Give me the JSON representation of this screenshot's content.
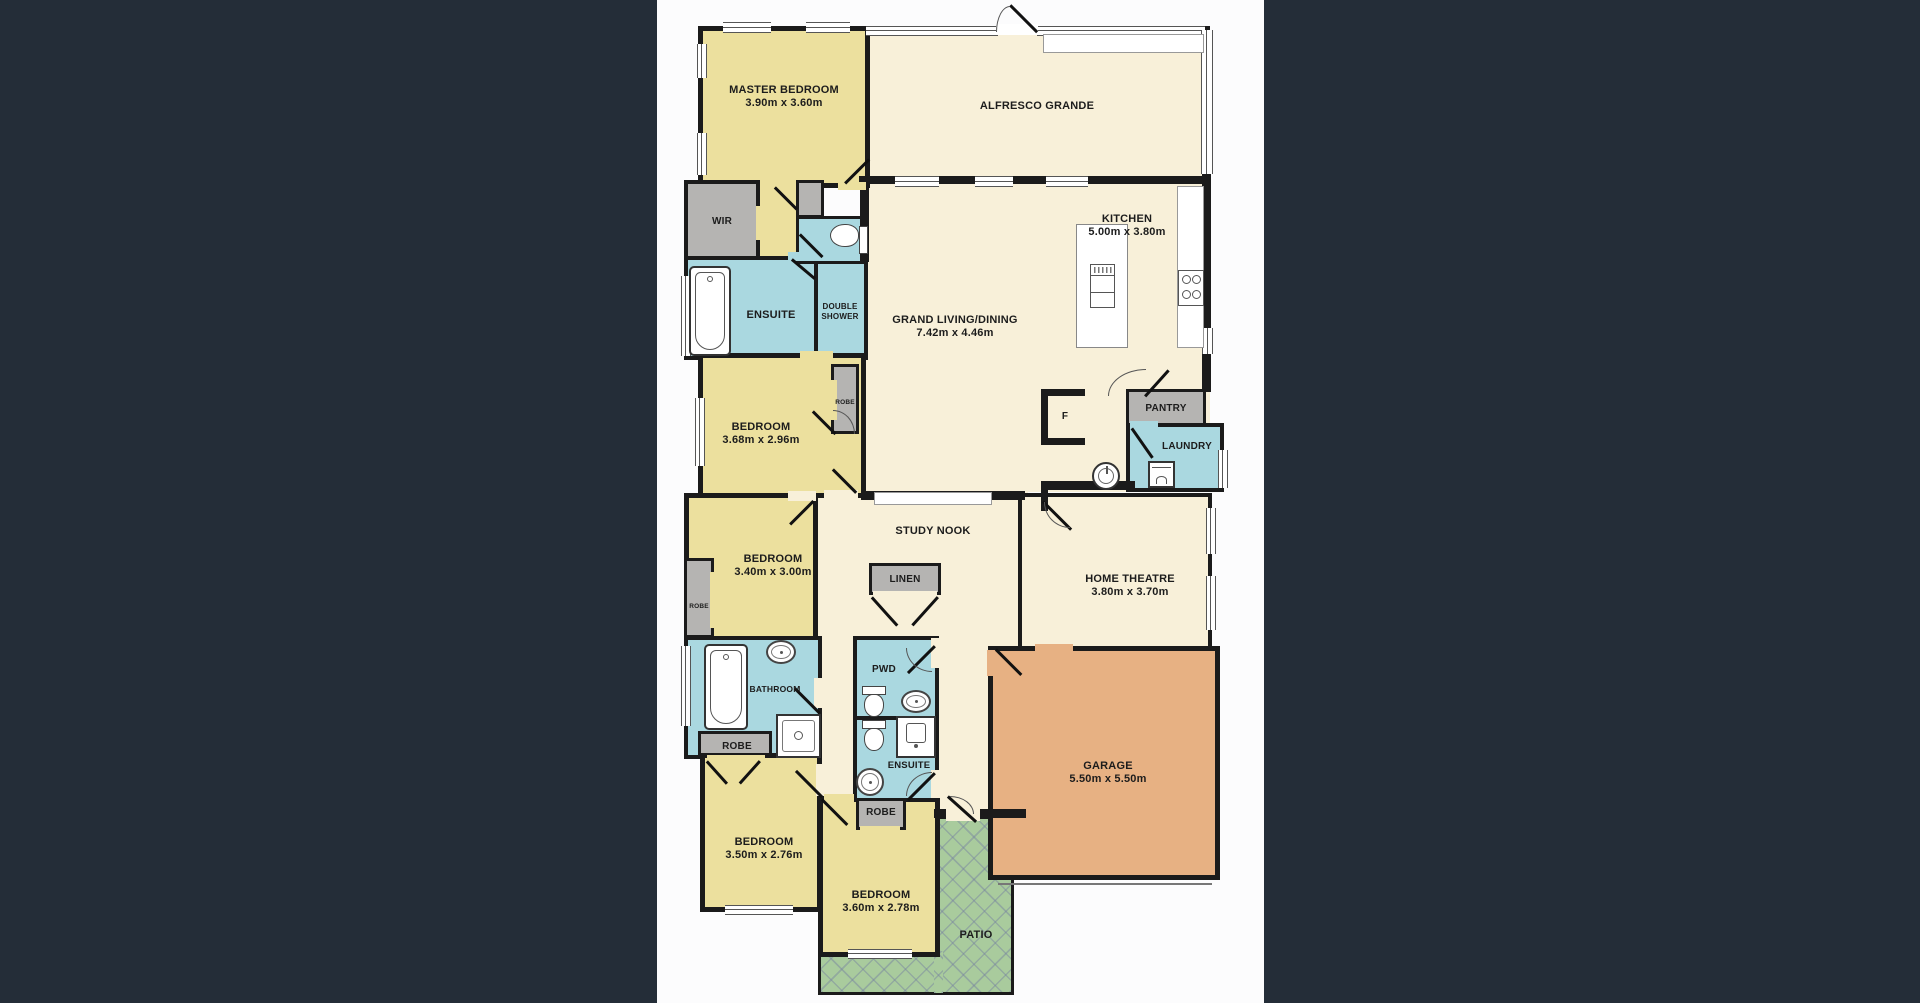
{
  "image": {
    "kind": "real-estate floor plan",
    "background_color": "#242d38",
    "canvas_color": "#fcfcfd",
    "canvas_x": 657,
    "canvas_width": 607
  },
  "plan": {
    "colors": {
      "cream": "#f8f0d9",
      "yellow": "#ece09e",
      "blue": "#aad8e0",
      "gray": "#b5b4b2",
      "orange": "#e7b183",
      "green": "#a9cb9d",
      "white": "#ffffff",
      "wall": "#1b1b1b",
      "text": "#1c1c1c"
    },
    "bases": [
      {
        "id": "living-kitchen",
        "x": 861,
        "y": 178,
        "w": 349,
        "h": 247,
        "f": "cream"
      },
      {
        "id": "hall-central",
        "x": 816,
        "y": 353,
        "w": 212,
        "h": 302,
        "f": "cream"
      },
      {
        "id": "mud-hall",
        "x": 1024,
        "y": 392,
        "w": 186,
        "h": 100,
        "f": "cream"
      },
      {
        "id": "entry-hall",
        "x": 934,
        "y": 648,
        "w": 58,
        "h": 168,
        "f": "cream"
      },
      {
        "id": "hall-bedrooms",
        "x": 818,
        "y": 653,
        "w": 38,
        "h": 165,
        "f": "cream"
      },
      {
        "id": "master-hall",
        "x": 756,
        "y": 180,
        "w": 62,
        "h": 178,
        "f": "yellow"
      }
    ],
    "rooms": [
      {
        "id": "alfresco",
        "x": 861,
        "y": 26,
        "w": 349,
        "h": 156,
        "f": "cream",
        "bw": 4
      },
      {
        "id": "master-bedroom",
        "x": 698,
        "y": 26,
        "w": 172,
        "h": 162,
        "f": "yellow",
        "bw": 5
      },
      {
        "id": "patio-strip",
        "x": 818,
        "y": 949,
        "w": 196,
        "h": 46,
        "f": "green",
        "bw": 3
      },
      {
        "id": "patio-main",
        "x": 934,
        "y": 816,
        "w": 80,
        "h": 179,
        "f": "green",
        "bw": 3
      },
      {
        "id": "patio-patch",
        "x": 934,
        "y": 951,
        "w": 9,
        "h": 42,
        "f": "green",
        "bw": 0
      },
      {
        "id": "wir",
        "x": 684,
        "y": 180,
        "w": 76,
        "h": 82,
        "f": "gray",
        "bw": 4
      },
      {
        "id": "ensuite-master",
        "x": 684,
        "y": 256,
        "w": 134,
        "h": 104,
        "f": "blue",
        "bw": 4
      },
      {
        "id": "double-shower",
        "x": 814,
        "y": 256,
        "w": 54,
        "h": 104,
        "f": "blue",
        "bw": 4
      },
      {
        "id": "wc-master",
        "x": 796,
        "y": 216,
        "w": 72,
        "h": 48,
        "f": "blue",
        "bw": 3
      },
      {
        "id": "wc-gray-block",
        "x": 796,
        "y": 180,
        "w": 28,
        "h": 38,
        "f": "gray",
        "bw": 3
      },
      {
        "id": "bedroom-2",
        "x": 698,
        "y": 353,
        "w": 168,
        "h": 145,
        "f": "yellow",
        "bw": 5
      },
      {
        "id": "robe-bedroom2",
        "x": 831,
        "y": 364,
        "w": 28,
        "h": 70,
        "f": "gray",
        "bw": 3
      },
      {
        "id": "bedroom-3",
        "x": 684,
        "y": 493,
        "w": 134,
        "h": 149,
        "f": "yellow",
        "bw": 5
      },
      {
        "id": "robe-bedroom3",
        "x": 684,
        "y": 558,
        "w": 30,
        "h": 80,
        "f": "gray",
        "bw": 3
      },
      {
        "id": "bathroom",
        "x": 684,
        "y": 636,
        "w": 138,
        "h": 123,
        "f": "blue",
        "bw": 4
      },
      {
        "id": "robe-bathroom",
        "x": 698,
        "y": 731,
        "w": 74,
        "h": 28,
        "f": "gray",
        "bw": 3
      },
      {
        "id": "bedroom-4",
        "x": 700,
        "y": 753,
        "w": 122,
        "h": 159,
        "f": "yellow",
        "bw": 5
      },
      {
        "id": "bedroom-5",
        "x": 818,
        "y": 796,
        "w": 122,
        "h": 161,
        "f": "yellow",
        "bw": 5
      },
      {
        "id": "pwd",
        "x": 853,
        "y": 636,
        "w": 86,
        "h": 84,
        "f": "blue",
        "bw": 4
      },
      {
        "id": "ensuite-2",
        "x": 853,
        "y": 716,
        "w": 86,
        "h": 86,
        "f": "blue",
        "bw": 4
      },
      {
        "id": "robe-bedroom5",
        "x": 856,
        "y": 798,
        "w": 50,
        "h": 32,
        "f": "gray",
        "bw": 3
      },
      {
        "id": "linen",
        "x": 869,
        "y": 563,
        "w": 72,
        "h": 32,
        "f": "gray",
        "bw": 3
      },
      {
        "id": "home-theatre",
        "x": 1018,
        "y": 493,
        "w": 194,
        "h": 162,
        "f": "cream",
        "bw": 4
      },
      {
        "id": "pantry",
        "x": 1126,
        "y": 389,
        "w": 80,
        "h": 38,
        "f": "gray",
        "bw": 3
      },
      {
        "id": "laundry",
        "x": 1126,
        "y": 423,
        "w": 98,
        "h": 69,
        "f": "blue",
        "bw": 4
      },
      {
        "id": "garage",
        "x": 988,
        "y": 646,
        "w": 232,
        "h": 234,
        "f": "orange",
        "bw": 5
      }
    ],
    "walls": [
      [
        859,
        176,
        351,
        8
      ],
      [
        1202,
        172,
        9,
        156
      ],
      [
        1202,
        354,
        9,
        38
      ],
      [
        860,
        178,
        9,
        84
      ],
      [
        861,
        491,
        164,
        9
      ],
      [
        1041,
        389,
        44,
        7
      ],
      [
        1041,
        389,
        7,
        56
      ],
      [
        1041,
        438,
        44,
        7
      ],
      [
        1041,
        481,
        94,
        9
      ],
      [
        1041,
        481,
        7,
        30
      ],
      [
        934,
        809,
        92,
        9
      ]
    ],
    "windows": [
      [
        723,
        22,
        48,
        9
      ],
      [
        806,
        22,
        44,
        9
      ],
      [
        866,
        26,
        132,
        8
      ],
      [
        1037,
        26,
        168,
        8
      ],
      [
        1201,
        30,
        10,
        144
      ],
      [
        697,
        44,
        8,
        34
      ],
      [
        697,
        133,
        8,
        42
      ],
      [
        681,
        276,
        8,
        80
      ],
      [
        695,
        398,
        8,
        68
      ],
      [
        681,
        646,
        8,
        80
      ],
      [
        725,
        905,
        68,
        8
      ],
      [
        848,
        949,
        64,
        8
      ],
      [
        895,
        176,
        44,
        9
      ],
      [
        975,
        176,
        38,
        9
      ],
      [
        1046,
        176,
        42,
        9
      ],
      [
        1202,
        328,
        9,
        26
      ],
      [
        1218,
        450,
        8,
        38
      ],
      [
        1206,
        508,
        8,
        46
      ],
      [
        1206,
        576,
        8,
        54
      ]
    ],
    "gaps": [
      [
        996,
        24,
        42,
        11,
        "white"
      ],
      [
        838,
        182,
        28,
        8,
        "yellow"
      ],
      [
        760,
        182,
        36,
        8,
        "yellow"
      ],
      [
        756,
        206,
        8,
        34,
        "yellow"
      ],
      [
        788,
        252,
        26,
        9,
        "blue"
      ],
      [
        800,
        351,
        33,
        9,
        "yellow"
      ],
      [
        824,
        490,
        34,
        9,
        "cream"
      ],
      [
        788,
        491,
        28,
        10,
        "cream"
      ],
      [
        829,
        380,
        8,
        40,
        "yellow"
      ],
      [
        710,
        572,
        8,
        56,
        "yellow"
      ],
      [
        814,
        678,
        10,
        30,
        "cream"
      ],
      [
        931,
        638,
        10,
        30,
        "cream"
      ],
      [
        931,
        770,
        10,
        28,
        "cream"
      ],
      [
        816,
        764,
        8,
        32,
        "cream"
      ],
      [
        824,
        794,
        30,
        10,
        "yellow"
      ],
      [
        860,
        826,
        40,
        8,
        "yellow"
      ],
      [
        707,
        755,
        58,
        8,
        "yellow"
      ],
      [
        873,
        591,
        64,
        8,
        "cream"
      ],
      [
        1130,
        421,
        28,
        9,
        "blue"
      ],
      [
        987,
        650,
        10,
        26,
        "orange"
      ],
      [
        1035,
        644,
        38,
        9,
        "orange"
      ],
      [
        946,
        809,
        34,
        12,
        "cream"
      ]
    ],
    "doors": [
      [
        845,
        182,
        34,
        -45
      ],
      [
        1037,
        31,
        38,
        -135
      ],
      [
        775,
        186,
        31,
        45
      ],
      [
        800,
        233,
        32,
        45
      ],
      [
        813,
        410,
        32,
        45
      ],
      [
        833,
        468,
        33,
        45
      ],
      [
        790,
        523,
        33,
        -45
      ],
      [
        872,
        596,
        38,
        48
      ],
      [
        938,
        596,
        38,
        132
      ],
      [
        795,
        687,
        35,
        45
      ],
      [
        935,
        645,
        38,
        135
      ],
      [
        935,
        772,
        38,
        135
      ],
      [
        822,
        796,
        37,
        -135
      ],
      [
        822,
        798,
        36,
        45
      ],
      [
        1043,
        500,
        40,
        45
      ],
      [
        996,
        648,
        36,
        45
      ],
      [
        1145,
        395,
        35,
        -48
      ],
      [
        948,
        795,
        38,
        42
      ],
      [
        1132,
        427,
        36,
        55
      ],
      [
        707,
        760,
        30,
        48
      ],
      [
        760,
        760,
        30,
        132
      ],
      [
        792,
        258,
        30,
        40
      ]
    ],
    "arcs": [
      [
        996,
        6,
        14,
        26,
        "tl"
      ],
      [
        1108,
        369,
        38,
        27,
        "tl"
      ],
      [
        1044,
        502,
        26,
        26,
        "bl"
      ],
      [
        906,
        648,
        26,
        24,
        "bl"
      ],
      [
        906,
        772,
        26,
        24,
        "tl"
      ],
      [
        833,
        410,
        22,
        24,
        "tr"
      ],
      [
        950,
        796,
        24,
        18,
        "tr"
      ]
    ],
    "fixtures": [
      {
        "t": "bench",
        "x": 1177,
        "y": 186,
        "w": 27,
        "h": 162
      },
      {
        "t": "island",
        "x": 1076,
        "y": 224,
        "w": 52,
        "h": 124
      },
      {
        "t": "cooktop",
        "x": 1178,
        "y": 270,
        "w": 26,
        "h": 36
      },
      {
        "t": "tub",
        "x": 689,
        "y": 266,
        "w": 42,
        "h": 90
      },
      {
        "t": "wc-h",
        "x": 830,
        "y": 226,
        "w": 38,
        "h": 28
      },
      {
        "t": "tub",
        "x": 704,
        "y": 644,
        "w": 44,
        "h": 86
      },
      {
        "t": "sinko",
        "x": 766,
        "y": 640,
        "w": 30,
        "h": 24
      },
      {
        "t": "shower",
        "x": 776,
        "y": 714,
        "w": 45,
        "h": 44
      },
      {
        "t": "wc-v",
        "x": 862,
        "y": 686,
        "w": 24,
        "h": 32
      },
      {
        "t": "sinko",
        "x": 901,
        "y": 690,
        "w": 30,
        "h": 23
      },
      {
        "t": "wc-v",
        "x": 862,
        "y": 720,
        "w": 24,
        "h": 32
      },
      {
        "t": "vanity",
        "x": 896,
        "y": 716,
        "w": 40,
        "h": 42
      },
      {
        "t": "sinkr",
        "x": 856,
        "y": 768,
        "w": 28,
        "h": 28
      },
      {
        "t": "washer",
        "x": 1148,
        "y": 461,
        "w": 27,
        "h": 27
      },
      {
        "t": "ltub",
        "x": 1092,
        "y": 462,
        "w": 28,
        "h": 28
      },
      {
        "t": "desk",
        "x": 874,
        "y": 492,
        "w": 118,
        "h": 13
      },
      {
        "t": "panel",
        "x": 1043,
        "y": 34,
        "w": 161,
        "h": 19
      },
      {
        "t": "line",
        "x": 998,
        "y": 883,
        "w": 214,
        "h": 2
      }
    ],
    "labels": [
      {
        "id": "master-bedroom",
        "t": [
          "MASTER BEDROOM",
          "3.90m x 3.60m"
        ],
        "x": 784,
        "cy": 97,
        "s": 11
      },
      {
        "id": "alfresco",
        "t": [
          "ALFRESCO GRANDE"
        ],
        "x": 1037,
        "cy": 107,
        "s": 11
      },
      {
        "id": "kitchen",
        "t": [
          "KITCHEN",
          "5.00m x 3.80m"
        ],
        "x": 1127,
        "cy": 226,
        "s": 11
      },
      {
        "id": "grand-living",
        "t": [
          "GRAND LIVING/DINING",
          "7.42m x 4.46m"
        ],
        "x": 955,
        "cy": 327,
        "s": 11
      },
      {
        "id": "wir",
        "t": [
          "WIR"
        ],
        "x": 722,
        "cy": 222,
        "s": 10
      },
      {
        "id": "ensuite-master",
        "t": [
          "ENSUITE"
        ],
        "x": 771,
        "cy": 316,
        "s": 11
      },
      {
        "id": "double-shower",
        "t": [
          "DOUBLE",
          "SHOWER"
        ],
        "x": 840,
        "cy": 312,
        "s": 8
      },
      {
        "id": "bedroom-2",
        "t": [
          "BEDROOM",
          "3.68m x 2.96m"
        ],
        "x": 761,
        "cy": 434,
        "s": 11
      },
      {
        "id": "robe-bedroom2",
        "t": [
          "ROBE"
        ],
        "x": 845,
        "cy": 402,
        "s": 6.5
      },
      {
        "id": "pantry",
        "t": [
          "PANTRY"
        ],
        "x": 1166,
        "cy": 409,
        "s": 10
      },
      {
        "id": "laundry",
        "t": [
          "LAUNDRY"
        ],
        "x": 1187,
        "cy": 447,
        "s": 10
      },
      {
        "id": "fridge",
        "t": [
          "F"
        ],
        "x": 1065,
        "cy": 417,
        "s": 10
      },
      {
        "id": "study-nook",
        "t": [
          "STUDY NOOK"
        ],
        "x": 933,
        "cy": 532,
        "s": 11
      },
      {
        "id": "linen",
        "t": [
          "LINEN"
        ],
        "x": 905,
        "cy": 580,
        "s": 10
      },
      {
        "id": "bedroom-3",
        "t": [
          "BEDROOM",
          "3.40m x 3.00m"
        ],
        "x": 773,
        "cy": 566,
        "s": 11
      },
      {
        "id": "robe-bedroom3",
        "t": [
          "ROBE"
        ],
        "x": 699,
        "cy": 606,
        "s": 6.5
      },
      {
        "id": "home-theatre",
        "t": [
          "HOME THEATRE",
          "3.80m x 3.70m"
        ],
        "x": 1130,
        "cy": 586,
        "s": 11
      },
      {
        "id": "bathroom",
        "t": [
          "BATHROOM"
        ],
        "x": 775,
        "cy": 689,
        "s": 8.5
      },
      {
        "id": "pwd",
        "t": [
          "PWD"
        ],
        "x": 884,
        "cy": 670,
        "s": 10
      },
      {
        "id": "ensuite-2",
        "t": [
          "ENSUITE"
        ],
        "x": 909,
        "cy": 766,
        "s": 9.5
      },
      {
        "id": "robe-bathroom",
        "t": [
          "ROBE"
        ],
        "x": 737,
        "cy": 747,
        "s": 10
      },
      {
        "id": "robe-bedroom5",
        "t": [
          "ROBE"
        ],
        "x": 881,
        "cy": 813,
        "s": 10
      },
      {
        "id": "garage",
        "t": [
          "GARAGE",
          "5.50m x 5.50m"
        ],
        "x": 1108,
        "cy": 773,
        "s": 11
      },
      {
        "id": "bedroom-4",
        "t": [
          "BEDROOM",
          "3.50m x 2.76m"
        ],
        "x": 764,
        "cy": 849,
        "s": 11
      },
      {
        "id": "bedroom-5",
        "t": [
          "BEDROOM",
          "3.60m x 2.78m"
        ],
        "x": 881,
        "cy": 902,
        "s": 11
      },
      {
        "id": "patio",
        "t": [
          "PATIO"
        ],
        "x": 976,
        "cy": 936,
        "s": 11
      }
    ]
  }
}
